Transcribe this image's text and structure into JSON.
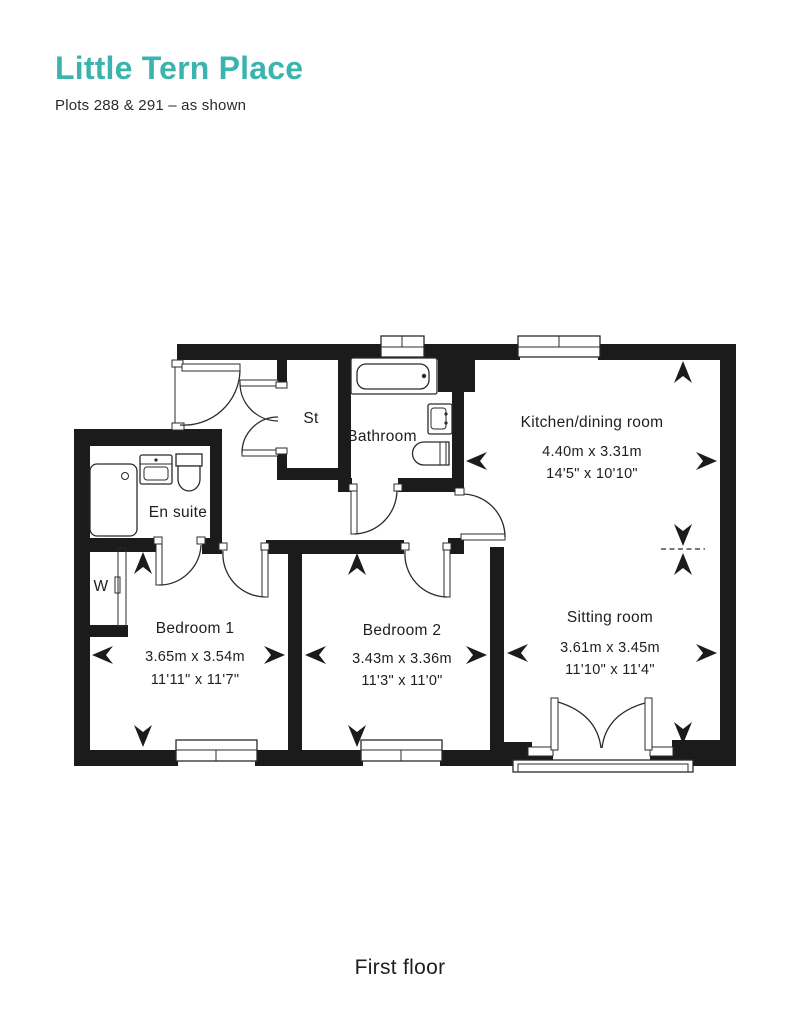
{
  "header": {
    "title": "Little Tern Place",
    "subtitle": "Plots 288 & 291 – as shown"
  },
  "floor_label": "First floor",
  "colors": {
    "accent": "#3CB4AE",
    "wall": "#1b1b1b",
    "line": "#2b2b2b",
    "text": "#1e1e1e"
  },
  "rooms": {
    "kitchen": {
      "name": "Kitchen/dining room",
      "metric": "4.40m x 3.31m",
      "imperial": "14'5\" x 10'10\""
    },
    "sitting": {
      "name": "Sitting room",
      "metric": "3.61m x 3.45m",
      "imperial": "11'10\" x 11'4\""
    },
    "bedroom1": {
      "name": "Bedroom 1",
      "metric": "3.65m x 3.54m",
      "imperial": "11'11\" x 11'7\""
    },
    "bedroom2": {
      "name": "Bedroom 2",
      "metric": "3.43m x 3.36m",
      "imperial": "11'3\" x 11'0\""
    },
    "bathroom": {
      "name": "Bathroom"
    },
    "ensuite": {
      "name": "En suite"
    },
    "store": {
      "abbr": "St"
    },
    "wardrobe": {
      "abbr": "W"
    }
  }
}
